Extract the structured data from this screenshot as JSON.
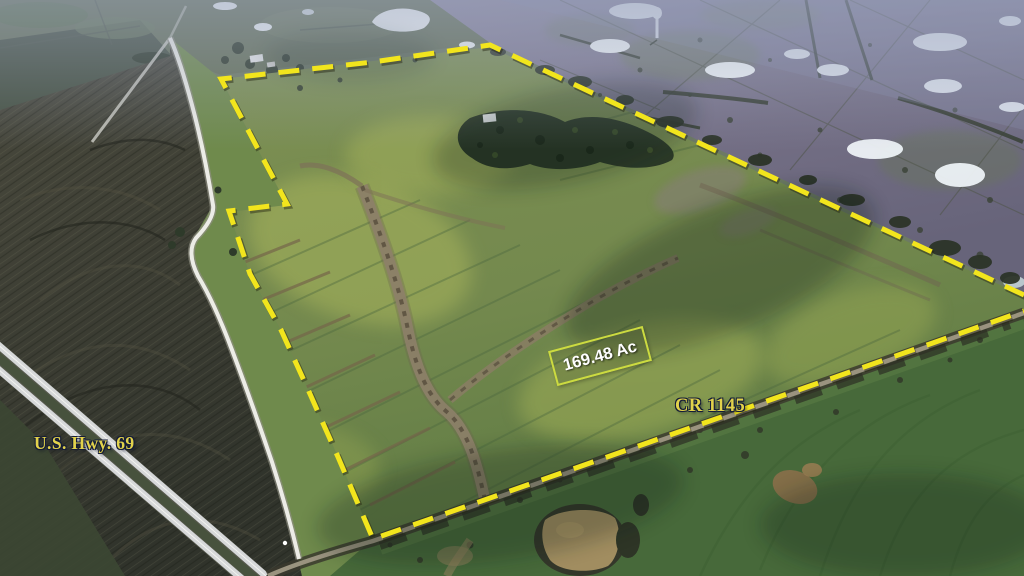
{
  "annotations": {
    "highway_label": "U.S. Hwy. 69",
    "county_road_label": "CR 1145",
    "acreage_label": "169.48 Ac"
  },
  "boundary": {
    "color": "#f2e51d",
    "dash_points": "1024,295 490,45 373,62 221,79 287,204 229,211 250,274 281,330 306,385 338,457 373,539 1024,311"
  },
  "colors": {
    "label_yellow": "#e2d24b",
    "acreage_text": "#ffffff",
    "acreage_box_border": "#ccdb40"
  }
}
